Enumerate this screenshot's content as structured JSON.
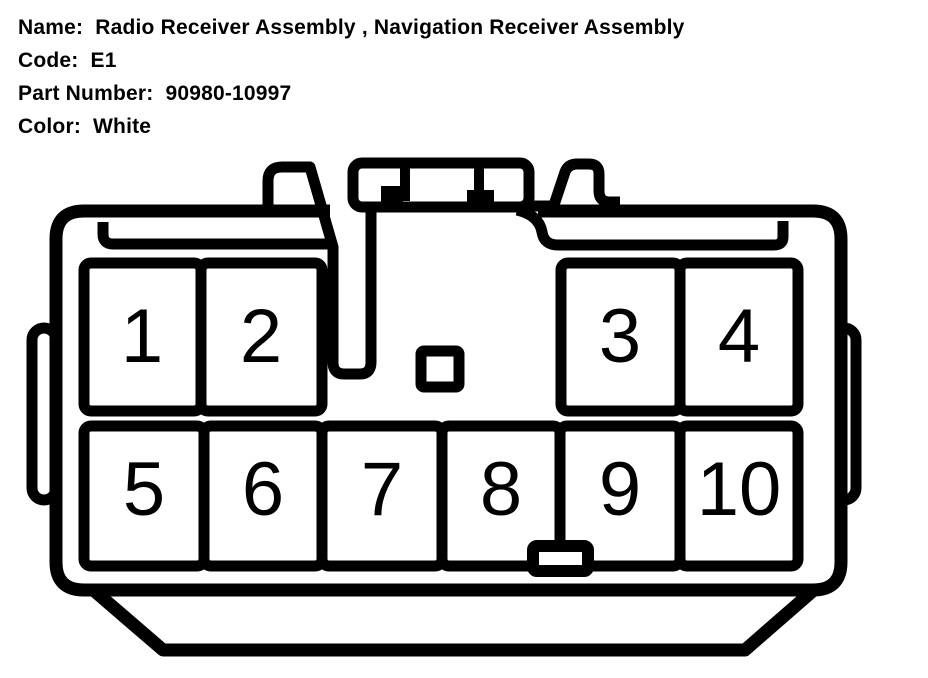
{
  "page": {
    "background_color": "#ffffff",
    "line_color": "#000000"
  },
  "header": {
    "fields": [
      {
        "label": "Name:",
        "value": "Radio Receiver Assembly , Navigation Receiver Assembly"
      },
      {
        "label": "Code:",
        "value": "E1"
      },
      {
        "label": "Part Number:",
        "value": "90980-10997"
      },
      {
        "label": "Color:",
        "value": "White"
      }
    ]
  },
  "connector": {
    "kind": "10-cavity connector, mating face view",
    "pins": [
      "1",
      "2",
      "3",
      "4",
      "5",
      "6",
      "7",
      "8",
      "9",
      "10"
    ]
  }
}
